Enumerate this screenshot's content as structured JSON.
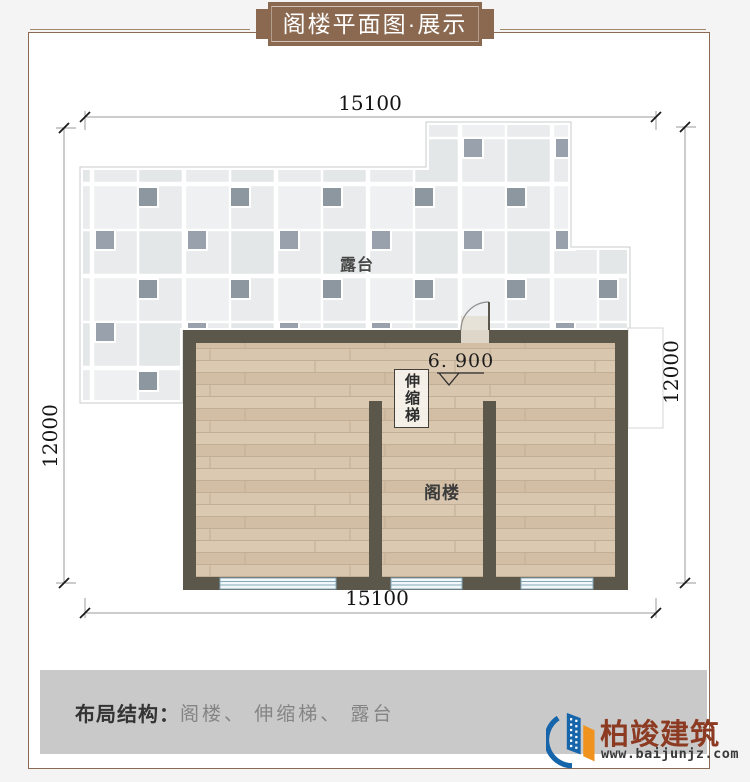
{
  "banner": {
    "title": "阁楼平面图·展示"
  },
  "plan": {
    "dim_top": "15100",
    "dim_bottom": "15100",
    "dim_left": "12000",
    "dim_right": "12000",
    "terrace_label": "露台",
    "attic_label": "阁楼",
    "ladder_label": "伸缩梯",
    "elevation": "6. 900"
  },
  "footer": {
    "label": "布局结构：",
    "value": "阁楼、 伸缩梯、 露台"
  },
  "brand": {
    "name": "柏竣建筑",
    "website": "www.baijunjz.com"
  },
  "colors": {
    "frame": "#8a6a52",
    "ribbon": "#8a6950",
    "wall": "#5b574b",
    "wood_floor": "#d6c3ab",
    "tile_light": "#e9ebec",
    "tile_dark": "#8d97a0",
    "window_blue": "#85a9ba",
    "footer_bar": "#c9c9c9",
    "brand_red": "#8c3a22",
    "logo_blue": "#1665aa",
    "logo_orange": "#f0921e"
  }
}
